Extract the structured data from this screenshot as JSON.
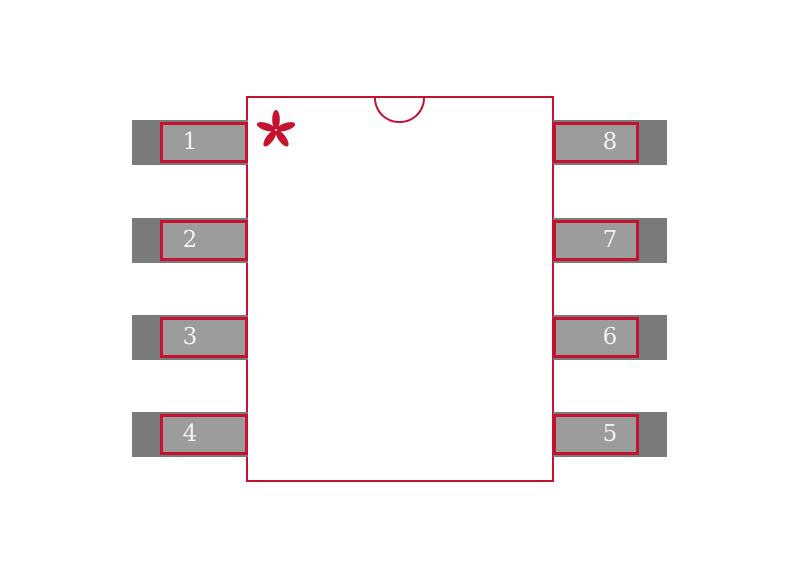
{
  "title": "SOIC-8 package footprint",
  "colors": {
    "background": "#FFFFFF",
    "outline": "#C41230",
    "pad_outer": "#7A7A7A",
    "pad_inner": "#9C9C9C",
    "pin_number": "#F2F2F2"
  },
  "package": {
    "pin1_marker": "asterisk",
    "index_notch": "top-center semicircle",
    "left_pins": [
      "1",
      "2",
      "3",
      "4"
    ],
    "right_pins": [
      "8",
      "7",
      "6",
      "5"
    ]
  }
}
